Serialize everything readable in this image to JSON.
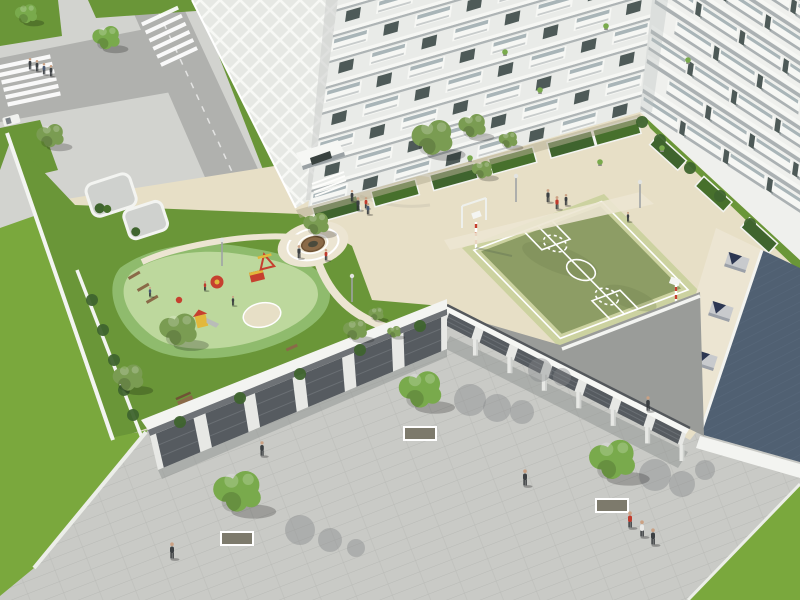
{
  "scene_label": "aerial-render-residential-courtyard",
  "palette": {
    "paving": "#c9cac6",
    "paving_line": "#b9bab6",
    "road": "#b0b1ae",
    "sidewalk": "#d2d3cf",
    "curb_white": "#eceee9",
    "grass_bright": "#7aa83d",
    "grass_mid": "#6a9638",
    "grass_dark": "#47702c",
    "hedge": "#3f642e",
    "play_surface": "#bdd89d",
    "play_border": "#8fbb6d",
    "sand": "#e7dfc6",
    "path_cream": "#ece5d2",
    "court_outer": "#ccd2a0",
    "court_inner": "#8d9d65",
    "white_line": "#ffffff",
    "wall_white": "#f3f4f1",
    "wall_light": "#e7e8e5",
    "wall_shade": "#cfd1ce",
    "facade_a": "#e9ebe8",
    "facade_b": "#eff0ed",
    "facade_dark": "#b9bfc1",
    "slab_white": "#f6f7f4",
    "slab_shadow": "#9aa1a4",
    "glass": "#a9b5b8",
    "window_dark": "#4e5a58",
    "window_deep": "#39423f",
    "opening_dark": "#565b60",
    "door_slat": "#73787d",
    "roof_dark": "#50607 2",
    "roof_dark_fix": "#506072",
    "roof_hatch": "#5c6d80",
    "skylight": "#c8cacd",
    "skylight_dark": "#2d3752",
    "shadow": "#8e918f",
    "shadow_warm": "#b5ad94",
    "wood": "#8a6a48",
    "wood_dark": "#6f5335",
    "red": "#c6402f",
    "yellow": "#e2b83c",
    "tree_olive": "#7a9c52",
    "tree_green": "#79aa4c",
    "tree_light": "#97c263",
    "trunk": "#74634c",
    "person_dark": "#3c4043",
    "person_red": "#bf3a2c",
    "person_blue": "#4a5a74",
    "person_white": "#e8e8e6",
    "pole": "#9fa3a5",
    "lattice": "#f7f8f5"
  },
  "facades": [
    {
      "gid": "fa-floors",
      "type": "zig",
      "floors": 8,
      "fh": 26,
      "len": 346,
      "mw": 43.3
    },
    {
      "gid": "fb-floors",
      "type": "bars",
      "floors": 9,
      "fh": 30,
      "len": 206,
      "mw": 52
    }
  ],
  "terraces": [
    {
      "line": [
        314,
        204,
        640,
        114
      ],
      "w": 46,
      "d": 16,
      "t": [
        0.06,
        0.24,
        0.42,
        0.6,
        0.78,
        0.92
      ]
    },
    {
      "line": [
        644,
        118,
        796,
        256
      ],
      "w": 38,
      "d": 13,
      "t": [
        0.2,
        0.5,
        0.8
      ]
    }
  ],
  "colonnades": [
    {
      "id": "garage-bays",
      "top": [
        150,
        436,
        447,
        315
      ],
      "bot": [
        158,
        470,
        447,
        349
      ],
      "n": 6,
      "columns": false
    },
    {
      "id": "canopy-bays",
      "top": [
        445,
        311,
        686,
        434
      ],
      "bot": [
        441,
        323,
        682,
        446
      ],
      "n": 7,
      "columns": true
    }
  ],
  "skylights": [
    {
      "x": 737,
      "y": 262
    },
    {
      "x": 721,
      "y": 311
    },
    {
      "x": 705,
      "y": 360
    },
    {
      "x": 689,
      "y": 407
    }
  ],
  "trees": [
    {
      "x": 26,
      "y": 14,
      "r": 13,
      "c": "tree_green"
    },
    {
      "x": 106,
      "y": 38,
      "r": 16,
      "c": "tree_green"
    },
    {
      "x": 50,
      "y": 136,
      "r": 16,
      "c": "tree_olive"
    },
    {
      "x": 316,
      "y": 224,
      "r": 15,
      "c": "tree_olive"
    },
    {
      "x": 432,
      "y": 138,
      "r": 24,
      "c": "tree_olive"
    },
    {
      "x": 472,
      "y": 126,
      "r": 16,
      "c": "tree_olive"
    },
    {
      "x": 508,
      "y": 140,
      "r": 11,
      "c": "tree_olive"
    },
    {
      "x": 482,
      "y": 170,
      "r": 12,
      "c": "tree_olive"
    },
    {
      "x": 178,
      "y": 330,
      "r": 22,
      "c": "tree_olive"
    },
    {
      "x": 128,
      "y": 378,
      "r": 18,
      "c": "tree_olive"
    },
    {
      "x": 355,
      "y": 330,
      "r": 14,
      "c": "tree_olive"
    },
    {
      "x": 376,
      "y": 314,
      "r": 9,
      "c": "tree_olive"
    },
    {
      "x": 394,
      "y": 332,
      "r": 8,
      "c": "tree_olive"
    },
    {
      "x": 420,
      "y": 390,
      "r": 25,
      "c": "tree_green",
      "planter": true
    },
    {
      "x": 612,
      "y": 460,
      "r": 27,
      "c": "tree_green",
      "planter": true
    },
    {
      "x": 237,
      "y": 492,
      "r": 28,
      "c": "tree_green",
      "planter": true
    }
  ],
  "people": [
    {
      "x": 30,
      "y": 64,
      "s": 0.7,
      "c": "person_dark"
    },
    {
      "x": 37,
      "y": 66,
      "s": 0.7,
      "c": "person_dark"
    },
    {
      "x": 44,
      "y": 69,
      "s": 0.7,
      "c": "person_blue"
    },
    {
      "x": 51,
      "y": 71,
      "s": 0.7,
      "c": "person_dark"
    },
    {
      "x": 525,
      "y": 478,
      "s": 1,
      "c": "person_dark"
    },
    {
      "x": 630,
      "y": 520,
      "s": 1,
      "c": "person_red"
    },
    {
      "x": 642,
      "y": 529,
      "s": 1,
      "c": "person_white"
    },
    {
      "x": 653,
      "y": 537,
      "s": 1,
      "c": "person_dark"
    },
    {
      "x": 172,
      "y": 551,
      "s": 1,
      "c": "person_dark"
    },
    {
      "x": 262,
      "y": 449,
      "s": 0.9,
      "c": "person_dark"
    },
    {
      "x": 648,
      "y": 404,
      "s": 0.9,
      "c": "person_dark"
    },
    {
      "x": 548,
      "y": 196,
      "s": 0.8,
      "c": "person_dark"
    },
    {
      "x": 557,
      "y": 203,
      "s": 0.8,
      "c": "person_red"
    },
    {
      "x": 566,
      "y": 200,
      "s": 0.7,
      "c": "person_dark"
    },
    {
      "x": 628,
      "y": 217,
      "s": 0.6,
      "c": "person_dark"
    },
    {
      "x": 352,
      "y": 196,
      "s": 0.7,
      "c": "person_dark"
    },
    {
      "x": 366,
      "y": 203,
      "s": 0.7,
      "c": "person_red"
    },
    {
      "x": 358,
      "y": 204,
      "s": 0.8,
      "c": "person_dark"
    },
    {
      "x": 368,
      "y": 209,
      "s": 0.7,
      "c": "person_blue"
    },
    {
      "x": 299,
      "y": 252,
      "s": 0.8,
      "c": "person_dark"
    },
    {
      "x": 326,
      "y": 255,
      "s": 0.7,
      "c": "person_red"
    },
    {
      "x": 205,
      "y": 286,
      "s": 0.6,
      "c": "person_red"
    },
    {
      "x": 233,
      "y": 301,
      "s": 0.6,
      "c": "person_dark"
    },
    {
      "x": 150,
      "y": 292,
      "s": 0.6,
      "c": "person_blue"
    }
  ],
  "poles": [
    {
      "x": 222,
      "y": 240
    },
    {
      "x": 352,
      "y": 276
    },
    {
      "x": 516,
      "y": 176
    },
    {
      "x": 640,
      "y": 182
    }
  ],
  "balcony_plants": [
    {
      "x": 505,
      "y": 52
    },
    {
      "x": 606,
      "y": 26
    },
    {
      "x": 662,
      "y": 148
    },
    {
      "x": 470,
      "y": 158
    },
    {
      "x": 688,
      "y": 60
    },
    {
      "x": 600,
      "y": 162
    },
    {
      "x": 540,
      "y": 90
    }
  ],
  "hedge_blobs": [
    {
      "x": 92,
      "y": 300
    },
    {
      "x": 103,
      "y": 330
    },
    {
      "x": 114,
      "y": 360
    },
    {
      "x": 124,
      "y": 390
    },
    {
      "x": 133,
      "y": 415
    },
    {
      "x": 642,
      "y": 122
    },
    {
      "x": 660,
      "y": 140
    },
    {
      "x": 690,
      "y": 168
    },
    {
      "x": 720,
      "y": 196
    },
    {
      "x": 750,
      "y": 224
    },
    {
      "x": 180,
      "y": 422
    },
    {
      "x": 240,
      "y": 398
    },
    {
      "x": 300,
      "y": 374
    },
    {
      "x": 360,
      "y": 350
    },
    {
      "x": 420,
      "y": 326
    }
  ],
  "zebras": [
    {
      "x0": 24,
      "y0": 62,
      "dx": 2,
      "dy": 7.4,
      "n": 6,
      "w": 54,
      "h": 4.2,
      "angle": -12
    },
    {
      "x0": 160,
      "y0": 16,
      "dx": 3.8,
      "dy": 8.1,
      "n": 6,
      "w": 40,
      "h": 4,
      "angle": -25
    }
  ],
  "shadow_clusters": [
    {
      "blobs": [
        [
          470,
          400,
          16
        ],
        [
          497,
          408,
          14
        ],
        [
          522,
          412,
          12
        ]
      ]
    },
    {
      "blobs": [
        [
          655,
          475,
          16
        ],
        [
          682,
          484,
          13
        ],
        [
          705,
          470,
          10
        ]
      ]
    },
    {
      "blobs": [
        [
          300,
          530,
          15
        ],
        [
          330,
          540,
          12
        ],
        [
          356,
          548,
          9
        ]
      ]
    },
    {
      "blobs": [
        [
          540,
          370,
          12
        ],
        [
          562,
          377,
          9
        ]
      ]
    }
  ]
}
